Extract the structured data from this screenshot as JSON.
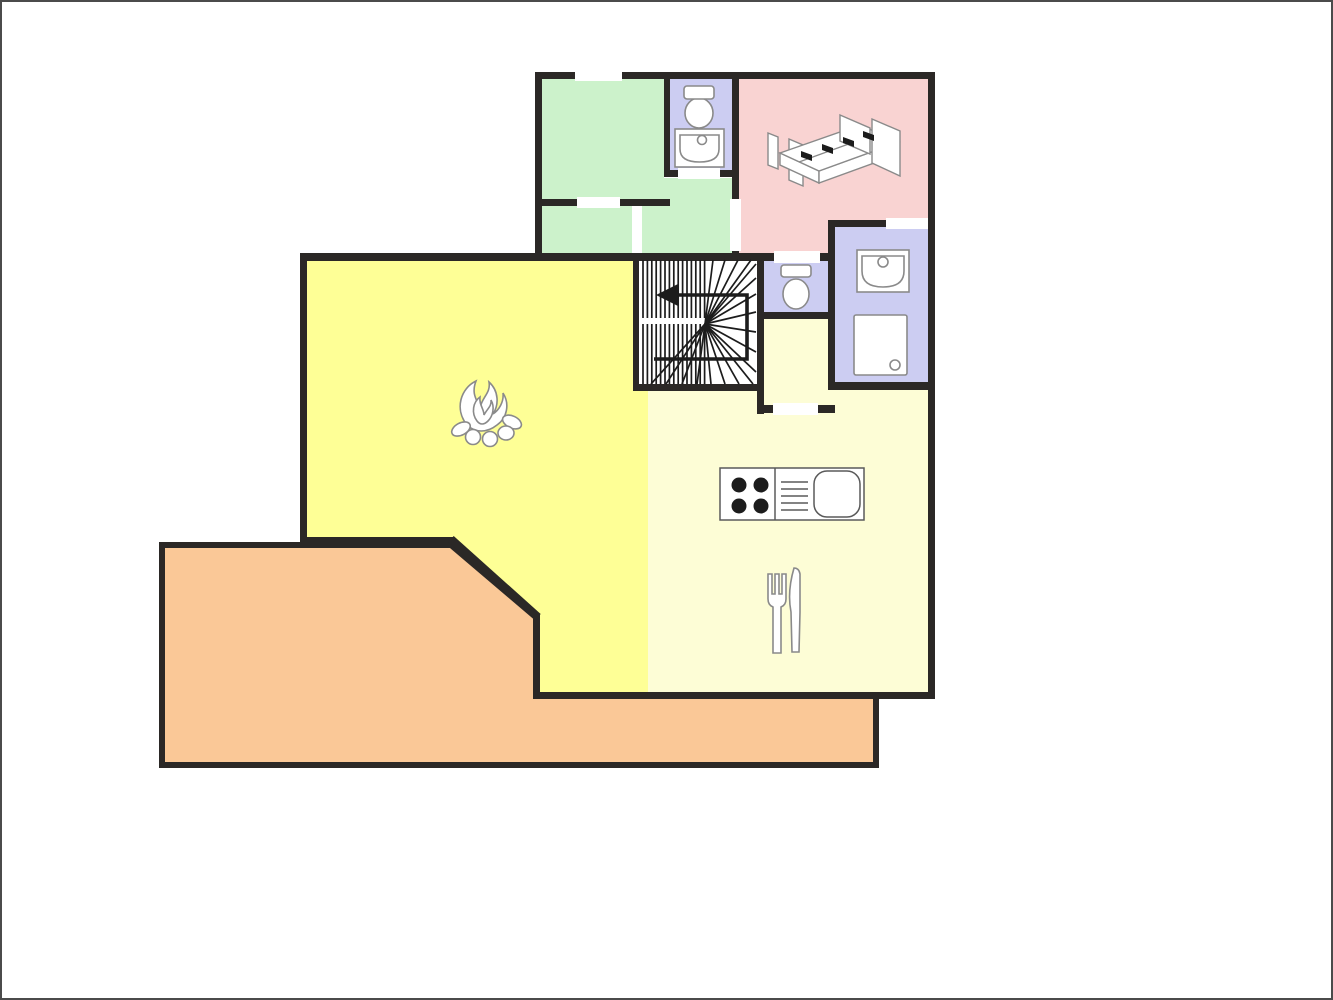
{
  "canvas": {
    "width": 1333,
    "height": 1000,
    "background": "#ffffff",
    "frame_color": "#4b4b4b"
  },
  "plan": {
    "wall_color": "#2b2826",
    "door_gap_color": "#ffffff",
    "fixture_stroke": "#8a8a8a",
    "fixture_fill": "#ffffff",
    "counter_stroke": "#5a5a5a",
    "stair_line_color": "#1c1c1c",
    "burner_color": "#1c1c1c",
    "bed_marker_color": "#1c1c1c",
    "rooms": {
      "terrace": {
        "color": "#fac897"
      },
      "living_room": {
        "color": "#feff96"
      },
      "kitchen_dining": {
        "color": "#fdfdd6"
      },
      "corridor": {
        "color": "#fdfdd6"
      },
      "bedroom": {
        "color": "#f9d3d2"
      },
      "green_room_top": {
        "color": "#ccf2cb"
      },
      "green_hall_right": {
        "color": "#ccf2cb"
      },
      "green_hall_left": {
        "color": "#ccf2cb"
      },
      "bathroom_upper": {
        "color": "#cccdf2"
      },
      "wc": {
        "color": "#cccdf2"
      },
      "bathroom_ensuite": {
        "color": "#cccdf2"
      },
      "staircase": {
        "color": "#ffffff"
      }
    },
    "icons": [
      "toilet-icon",
      "washbasin-icon",
      "double-bed-icon",
      "shower-icon",
      "campfire-fireplace-icon",
      "stove-burners-icon",
      "kitchen-sink-icon",
      "fork-icon",
      "knife-icon",
      "stairs-winder-icon",
      "direction-arrow-icon"
    ]
  }
}
